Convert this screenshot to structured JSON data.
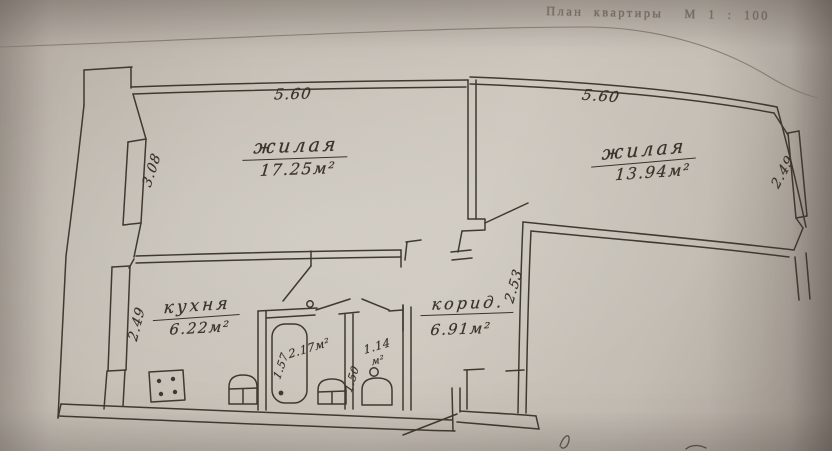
{
  "title": "План квартиры  М 1 : 100",
  "colors": {
    "paper": "#c7c1b8",
    "ink": "#3f3930",
    "faded_print": "#6e665c"
  },
  "rooms": {
    "living1": {
      "name": "жилая",
      "area": "17.25м²",
      "dim_top": "5.60",
      "dim_side": "3.08"
    },
    "living2": {
      "name": "жилая",
      "area": "13.94м²",
      "dim_top": "5.60",
      "dim_side": "2.49"
    },
    "kitchen": {
      "name": "кухня",
      "area": "6.22м²",
      "dim_side": "2.49"
    },
    "corridor": {
      "name": "корид.",
      "area": "6.91м²",
      "dim_side": "2.53"
    },
    "bathroom": {
      "area": "2.17м²",
      "dim_side": "1.57"
    },
    "wc": {
      "area": "1.14",
      "unit": "м²",
      "dim_side": "1.50"
    }
  },
  "fixtures": [
    "stove-icon",
    "water-heater-icon",
    "bathtub-icon",
    "sink-icon",
    "toilet-icon"
  ]
}
